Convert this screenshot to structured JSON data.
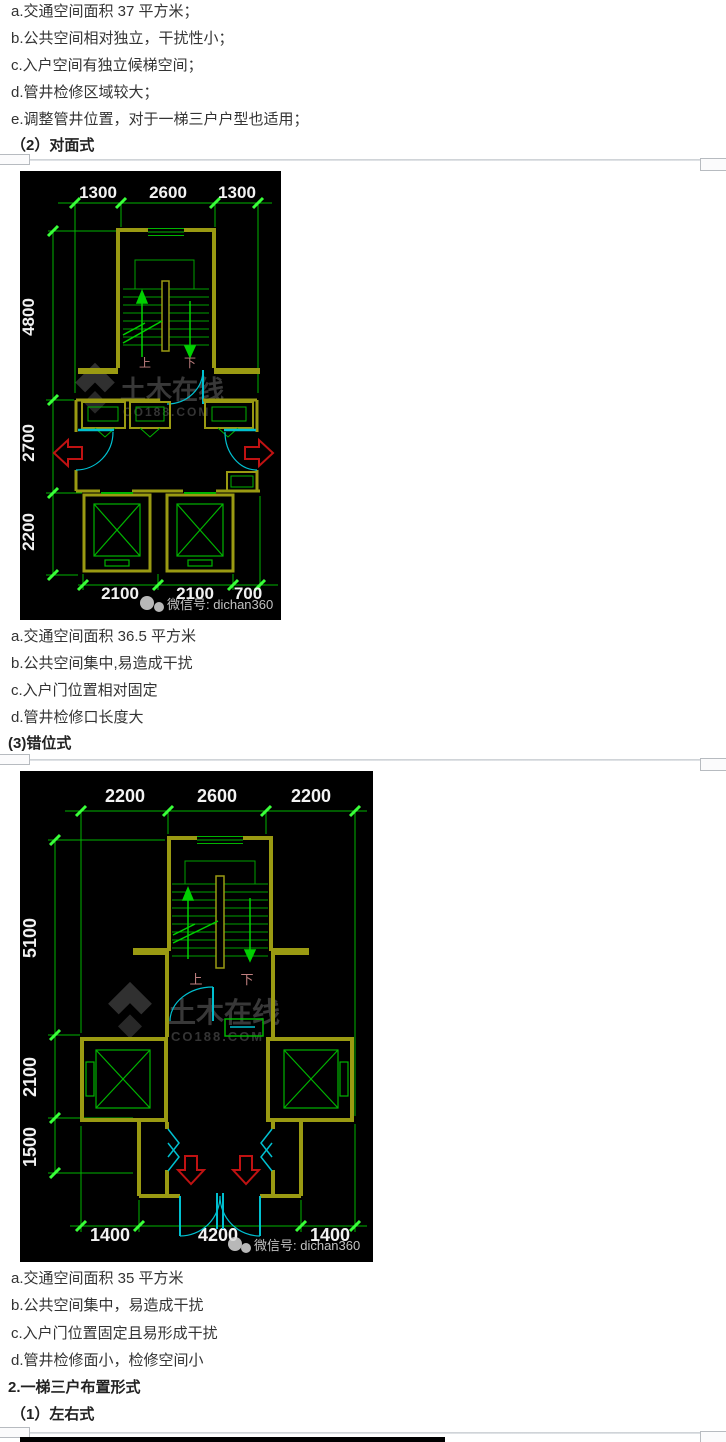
{
  "intro": {
    "items": [
      "a.交通空间面积 37 平方米；",
      "b.公共空间相对独立，干扰性小；",
      "c.入户空间有独立候梯空间；",
      "d.管井检修区域较大；",
      "e.调整管井位置，对于一梯三户户型也适用；"
    ]
  },
  "duimian": {
    "heading": "（2）对面式",
    "items": [
      "a.交通空间面积 36.5 平方米",
      "b.公共空间集中,易造成干扰",
      "c.入户门位置相对固定",
      "d.管井检修口长度大"
    ]
  },
  "cuowei": {
    "heading": "(3)错位式",
    "items": [
      "a.交通空间面积 35 平方米",
      "b.公共空间集中，易造成干扰",
      "c.入户门位置固定且易形成干扰",
      "d.管井检修面小，检修空间小"
    ]
  },
  "santihu": {
    "heading": "2.一梯三户布置形式",
    "sub_heading": "（1）左右式"
  },
  "plan_duimian": {
    "dims_top": [
      "1300",
      "2600",
      "1300"
    ],
    "dims_left": [
      "4800",
      "2700",
      "2200"
    ],
    "dims_bottom": [
      "2100",
      "2100",
      "700"
    ],
    "up": "上",
    "down": "下",
    "watermark": {
      "name": "土木在线",
      "site": "CO188.COM",
      "wechat": "微信号: dichan360"
    }
  },
  "plan_cuowei": {
    "dims_top": [
      "2200",
      "2600",
      "2200"
    ],
    "dims_left": [
      "5100",
      "2100",
      "1500"
    ],
    "dims_bottom": [
      "1400",
      "4200",
      "1400"
    ],
    "up": "上",
    "down": "下",
    "watermark": {
      "name": "土木在线",
      "site": "CO188.COM",
      "wechat": "微信号: dichan360"
    }
  },
  "colors": {
    "cad_background": "#000000",
    "wall_olive": "#9a9a12",
    "dim_green": "#00b400",
    "tick_green": "#39ff39",
    "detail_green": "#00c83c",
    "door_cyan": "#00c0d0",
    "arrow_red": "#c01212",
    "stair_label_rose": "#c08080",
    "dim_text_white": "#f2f2f2",
    "body_text": "#333333",
    "divider_gray": "#d0d4d8"
  }
}
